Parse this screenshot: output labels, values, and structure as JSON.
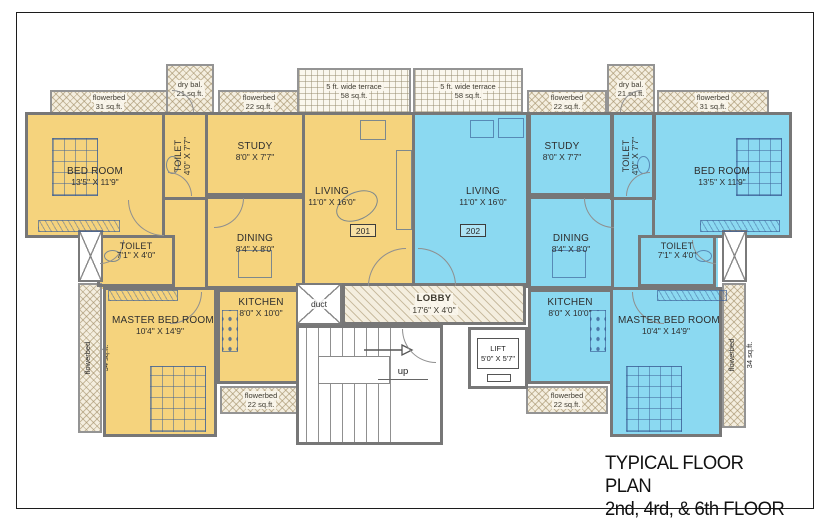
{
  "title": {
    "line1": "TYPICAL FLOOR PLAN",
    "line2": "2nd, 4rd,  & 6th FLOOR"
  },
  "colors": {
    "unit_201": "#F5D37D",
    "unit_202": "#8BD9F1",
    "wall": "#777777",
    "hatch_bg": "#F4EEDF"
  },
  "strips": {
    "fb31": {
      "line1": "flowerbed",
      "line2": "31 sq.ft."
    },
    "fb22": {
      "line1": "flowerbed",
      "line2": "22 sq.ft."
    },
    "fb34": {
      "line1": "flowerbed",
      "line2": "34 sq.ft."
    },
    "drybal": {
      "line1": "dry bal.",
      "line2": "21 sq.ft."
    },
    "terrace": {
      "line1": "5 ft. wide terrace",
      "line2": "58 sq.ft."
    }
  },
  "core": {
    "duct": "duct",
    "lobby": {
      "name": "LOBBY",
      "dim": "17'6\" X 4'0\""
    },
    "lift": {
      "name": "LIFT",
      "dim": "5'0\" X 5'7\""
    },
    "stairs_up": "up"
  },
  "units": {
    "left": {
      "number": "201",
      "bedroom": {
        "name": "BED ROOM",
        "dim": "13'5\" X 11'9\""
      },
      "toilet_top": {
        "name": "TOILET",
        "dim": "4'0\" X 7'7\""
      },
      "study": {
        "name": "STUDY",
        "dim": "8'0\" X 7'7\""
      },
      "living": {
        "name": "LIVING",
        "dim": "11'0\" X 16'0\""
      },
      "toilet2": {
        "name": "TOILET",
        "dim": "7'1\" X 4'0\""
      },
      "dining": {
        "name": "DINING",
        "dim": "8'4\" X 8'0\""
      },
      "kitchen": {
        "name": "KITCHEN",
        "dim": "8'0\" X 10'0\""
      },
      "master": {
        "name": "MASTER BED ROOM",
        "dim": "10'4\" X 14'9\""
      }
    },
    "right": {
      "number": "202",
      "bedroom": {
        "name": "BED ROOM",
        "dim": "13'5\" X 11'9\""
      },
      "toilet_top": {
        "name": "TOILET",
        "dim": "4'0\" X 7'7\""
      },
      "study": {
        "name": "STUDY",
        "dim": "8'0\" X 7'7\""
      },
      "living": {
        "name": "LIVING",
        "dim": "11'0\" X 16'0\""
      },
      "toilet2": {
        "name": "TOILET",
        "dim": "7'1\" X 4'0\""
      },
      "dining": {
        "name": "DINING",
        "dim": "8'4\" X 8'0\""
      },
      "kitchen": {
        "name": "KITCHEN",
        "dim": "8'0\" X 10'0\""
      },
      "master": {
        "name": "MASTER BED ROOM",
        "dim": "10'4\" X 14'9\""
      }
    }
  }
}
